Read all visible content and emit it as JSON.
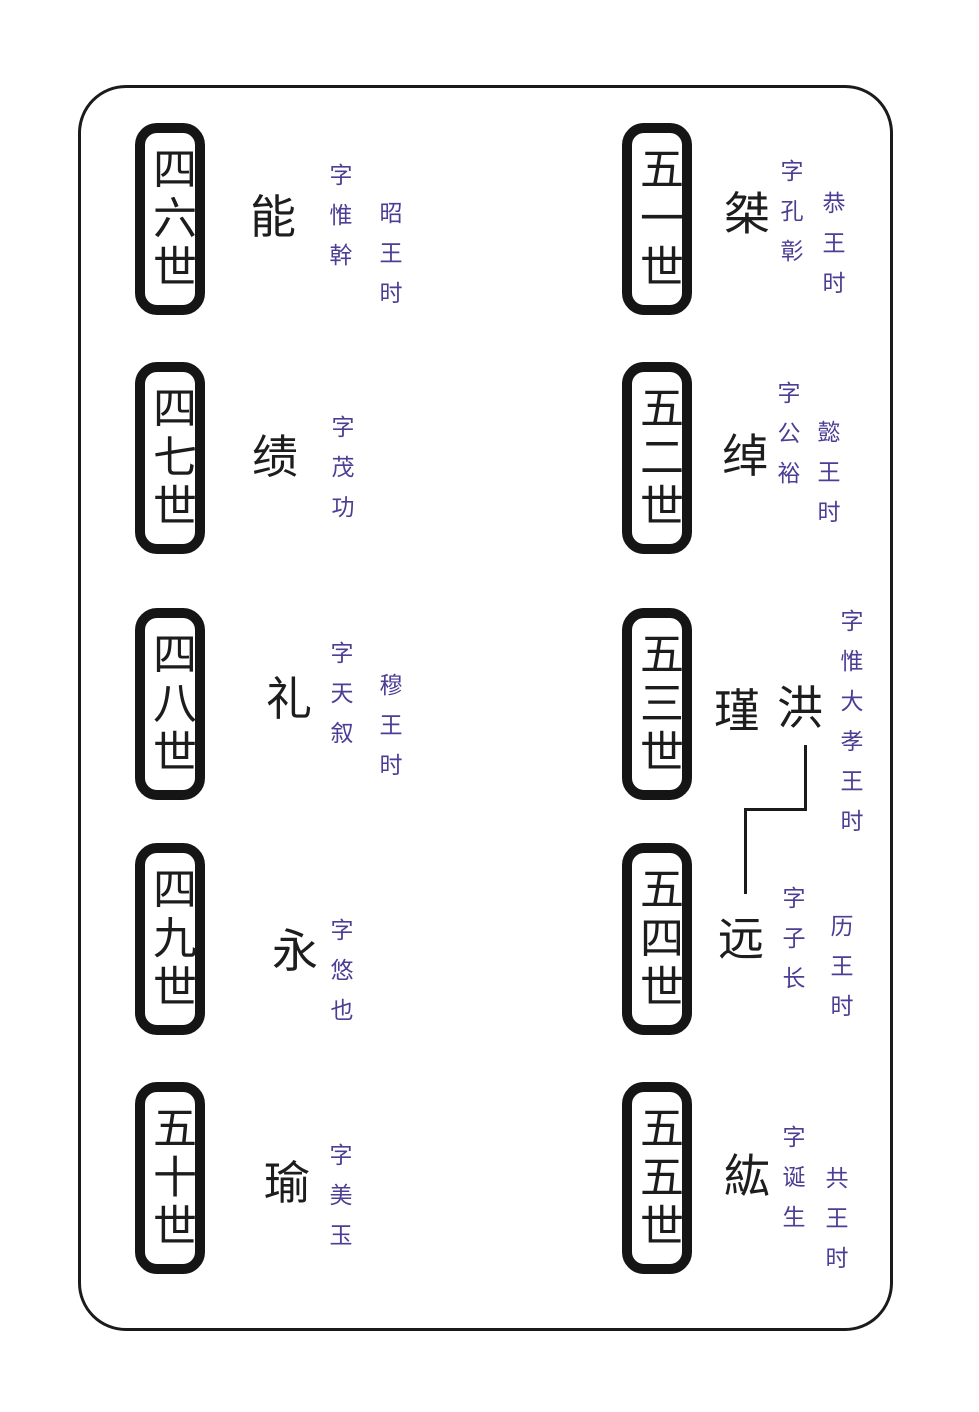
{
  "colors": {
    "ink": "#1c1c1c",
    "annotation_purple": "#4b3e94",
    "background": "#ffffff"
  },
  "entries": [
    {
      "generation": "四六世",
      "name": "能",
      "zi": "字惟幹",
      "era": "昭王时"
    },
    {
      "generation": "四七世",
      "name": "绩",
      "zi": "字茂功",
      "era": ""
    },
    {
      "generation": "四八世",
      "name": "礼",
      "zi": "字天叙",
      "era": "穆王时"
    },
    {
      "generation": "四九世",
      "name": "永",
      "zi": "字悠也",
      "era": ""
    },
    {
      "generation": "五十世",
      "name": "瑜",
      "zi": "字美玉",
      "era": ""
    },
    {
      "generation": "五一世",
      "name": "桀",
      "zi": "字孔彰",
      "era": "恭王时"
    },
    {
      "generation": "五二世",
      "name": "绰",
      "zi": "字公裕",
      "era": "懿王时"
    },
    {
      "generation": "五三世",
      "name": "瑾",
      "name2": "洪",
      "zi": "字惟大",
      "era": "孝王时"
    },
    {
      "generation": "五四世",
      "name": "远",
      "zi": "字子长",
      "era": "历王时"
    },
    {
      "generation": "五五世",
      "name": "紘",
      "zi": "字诞生",
      "era": "共王时"
    }
  ],
  "lineage_link": {
    "from": "洪",
    "to": "远"
  }
}
